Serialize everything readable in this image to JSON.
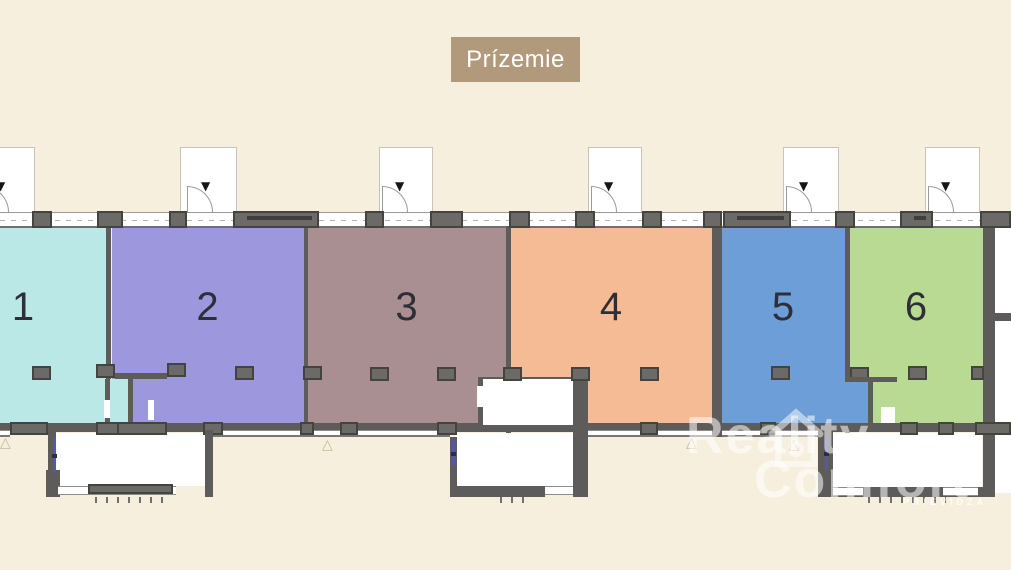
{
  "floor_label": "Prízemie",
  "units": [
    {
      "number": "1",
      "color": "#b9e8e6"
    },
    {
      "number": "2",
      "color": "#9d97de"
    },
    {
      "number": "3",
      "color": "#a98e92"
    },
    {
      "number": "4",
      "color": "#f5bb95"
    },
    {
      "number": "5",
      "color": "#6d9ed7"
    },
    {
      "number": "6",
      "color": "#b9da92"
    }
  ],
  "icons": {
    "entrance_arrow": "▼",
    "elevation_marker": "△"
  },
  "watermark": {
    "brand_line1": "Reality",
    "brand_line2": "Comfort",
    "city": "PRIEVIDZA"
  },
  "colors": {
    "background": "#f6efde",
    "floor_label_bg": "#b1997b",
    "floor_label_text": "#ffffff",
    "wall": "#5d5c5a",
    "pier_fill": "#6b6a66",
    "unit_number_text": "#2e2e38"
  }
}
